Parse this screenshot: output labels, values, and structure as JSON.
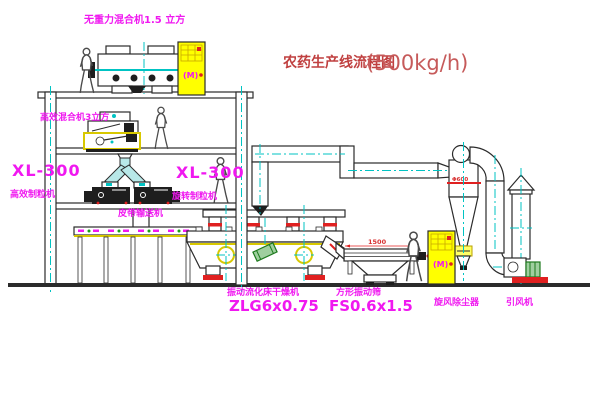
{
  "title": {
    "name": "农药生产线流程图",
    "capacity": "(500kg/h)"
  },
  "equipment": {
    "top_mixer": {
      "label": "无重力混合机1.5 立方"
    },
    "second_mixer": {
      "label": "高效混合机3立方"
    },
    "granulator_left": {
      "model": "XL-300",
      "name": "高效制粒机"
    },
    "granulator_mid": {
      "model": "XL-300",
      "name": "旋转制粒机"
    },
    "belt_conveyor": {
      "name": "皮带输送机"
    },
    "dryer": {
      "name": "振动流化床干燥机",
      "model": "ZLG6x0.75"
    },
    "screen": {
      "name": "方形振动筛",
      "model": "FS0.6x1.5"
    },
    "cyclone": {
      "name": "旋风除尘器"
    },
    "fan": {
      "name": "引风机"
    },
    "cabinet": {
      "motor_mark": "(M)"
    }
  },
  "dimensions": {
    "screen_width": "1500",
    "cyclone_line": "Φ600"
  },
  "colors": {
    "label_magenta": "#f018f0",
    "title_red": "#c04040",
    "centerline_cyan": "#00c3c3",
    "outline": "#2b2b2b",
    "cabinet_yellow": "#ffff00",
    "accent_red": "#e02020",
    "motor_green": "#1e7a1e"
  }
}
